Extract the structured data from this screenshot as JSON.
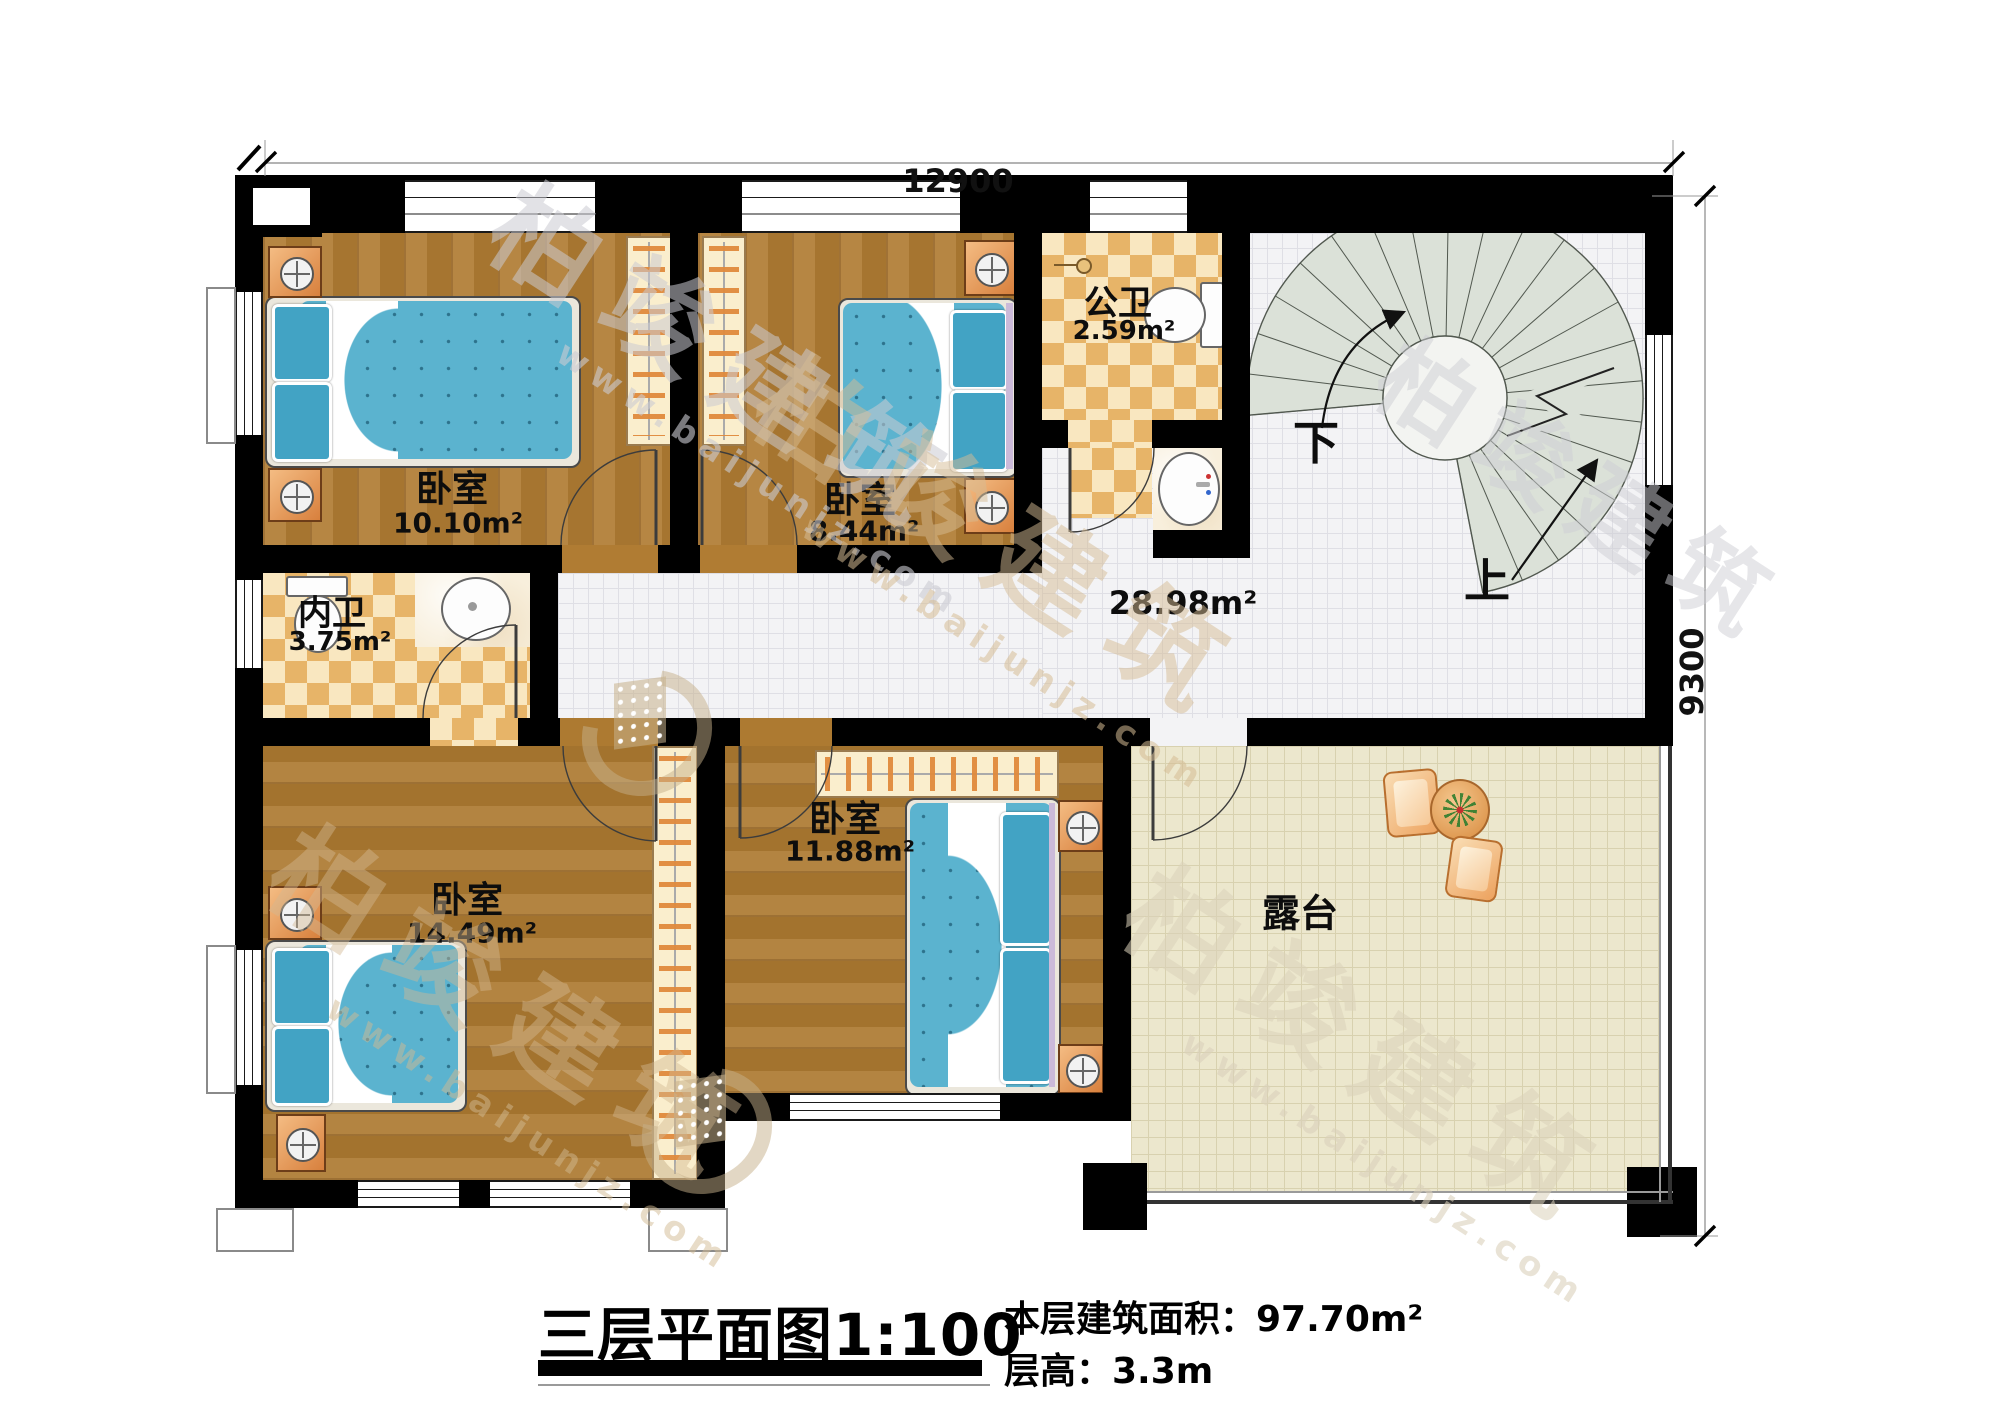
{
  "dimensions": {
    "top": "12900",
    "right": "9300"
  },
  "rooms": {
    "bedroom_top_left": {
      "name": "卧室",
      "area": "10.10m²"
    },
    "bedroom_top_mid": {
      "name": "卧室",
      "area": "8.44m²"
    },
    "public_bath": {
      "name": "公卫",
      "area": "2.59m²"
    },
    "inner_bath": {
      "name": "内卫",
      "area": "3.75m²"
    },
    "hall": {
      "area": "28.98m²"
    },
    "bedroom_bottom_left": {
      "name": "卧室",
      "area": "14.49m²"
    },
    "bedroom_bottom_mid": {
      "name": "卧室",
      "area": "11.88m²"
    },
    "terrace": {
      "name": "露台"
    }
  },
  "stairs": {
    "down_label": "下",
    "up_label": "上"
  },
  "title_block": {
    "title": "三层平面图1:100",
    "area_line": "本层建筑面积：97.70m²",
    "height_line": "层高：3.3m"
  },
  "watermark": {
    "brand": "柏竣建筑",
    "site": "www.baijunjz.com"
  }
}
